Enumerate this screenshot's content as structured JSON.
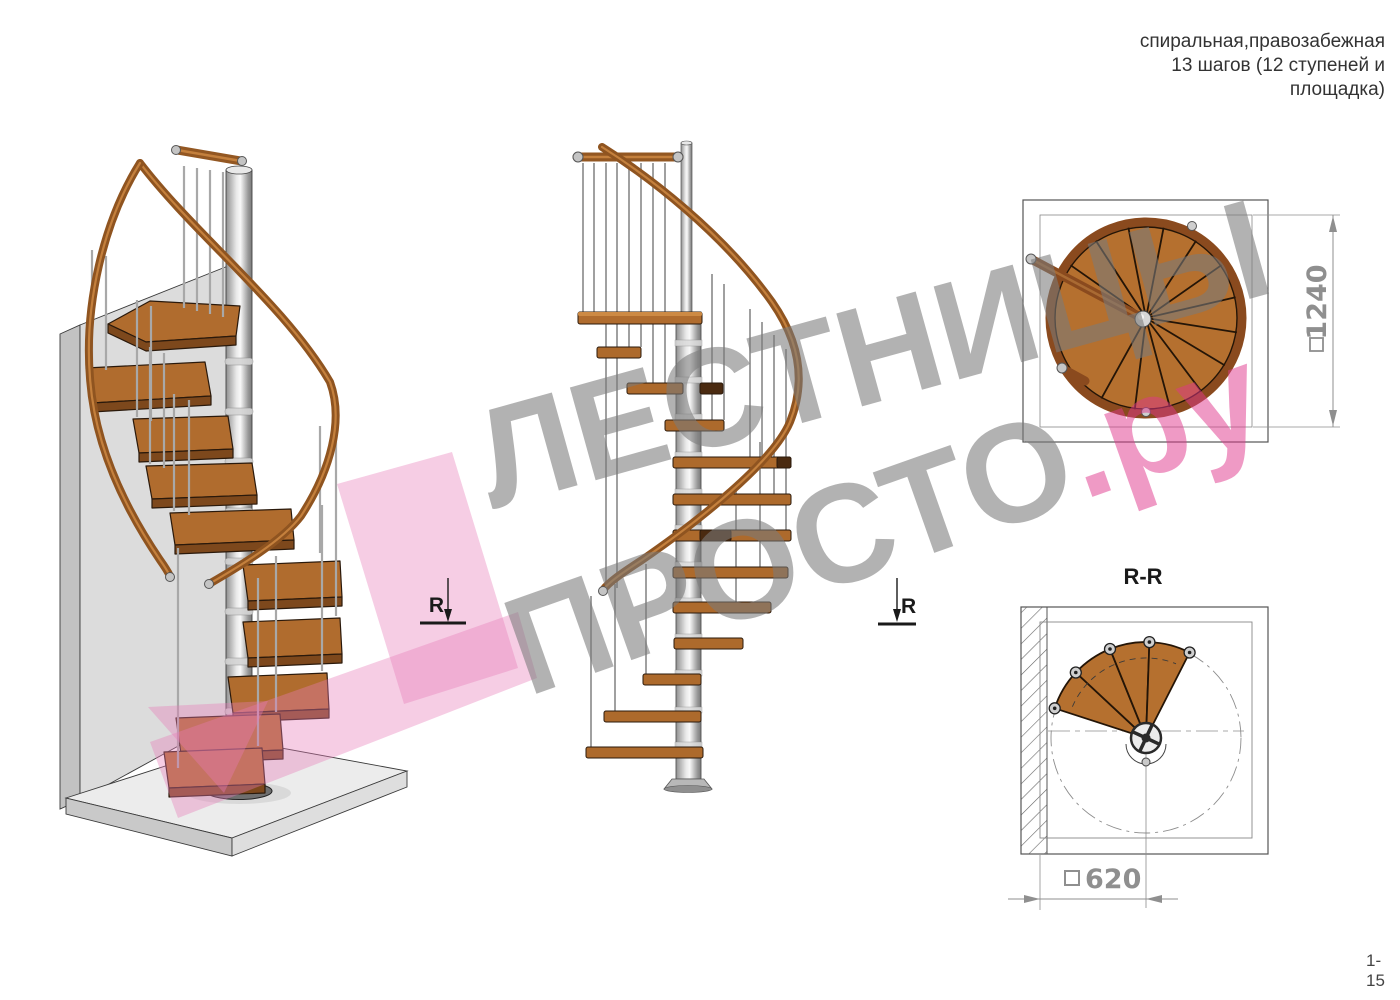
{
  "header": {
    "title_line1": "спиральная,правозабежная",
    "title_line2": "13 шагов (12 ступеней и",
    "title_line3": "площадка)"
  },
  "footer": {
    "page_number": "1-15"
  },
  "watermark": {
    "line1": "ЛЕСТНИЦЫ",
    "line2_gray": "ПРОСТО",
    "line2_pink": ".ру",
    "gray_color": "#7a7a7a",
    "pink_color": "#e0368c"
  },
  "annotations": {
    "section_title": "R-R",
    "section_marker_left": "R",
    "section_marker_right": "R"
  },
  "dimensions": {
    "plan_overall": "1240",
    "section_width": "620"
  },
  "colors": {
    "wood": "#b06c2e",
    "wood_dark_edge": "#7d481c",
    "handrail": "#8f5420",
    "metal_column": "#c9c9c9",
    "wall_gray": "#d9d9d9",
    "dimension_gray": "#8f8f8f",
    "line_black": "#222222"
  }
}
